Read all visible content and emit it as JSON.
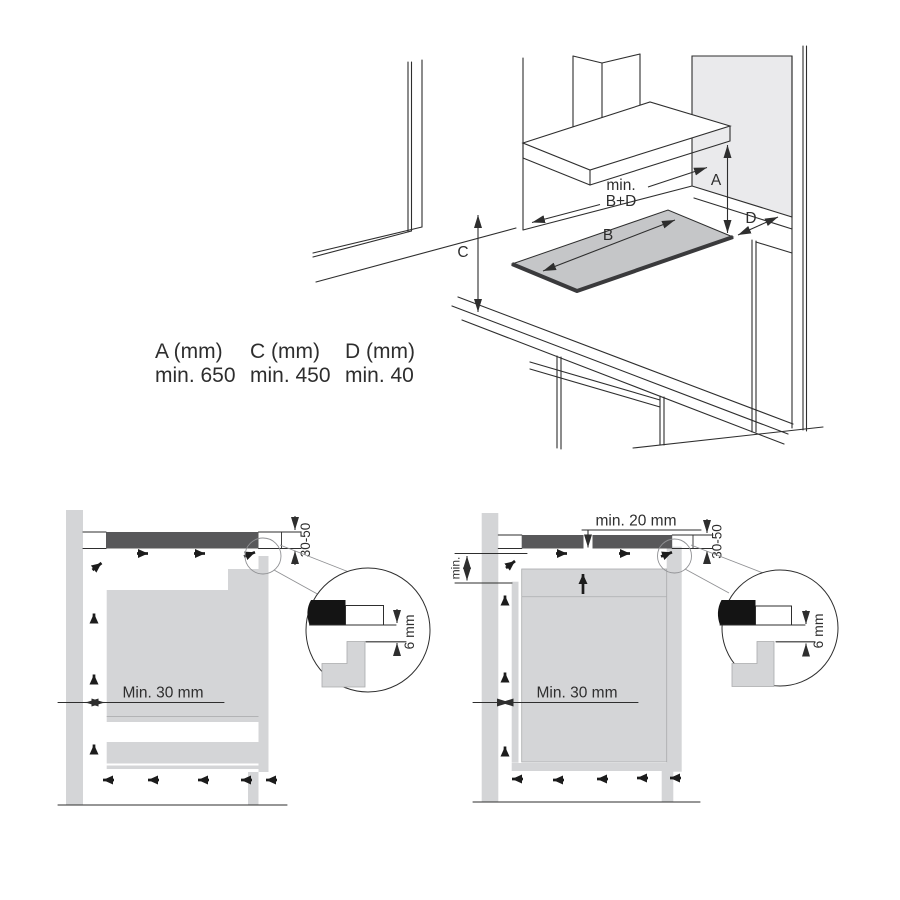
{
  "colors": {
    "line": "#2e2e2e",
    "hob_dark": "#58585a",
    "fill_light": "#d4d5d7",
    "panel_light": "#eaeaec",
    "hob_top": "#c5c6c8",
    "edge_black": "#141414",
    "leader_gray": "#909194",
    "text": "#2e2e2e",
    "bg": "#ffffff"
  },
  "table": {
    "columns": [
      {
        "header": "A (mm)",
        "value": "min. 650"
      },
      {
        "header": "C (mm)",
        "value": "min. 450"
      },
      {
        "header": "D (mm)",
        "value": "min. 40"
      }
    ]
  },
  "top_diagram": {
    "labels": {
      "min": "min.",
      "b_plus_d": "B+D",
      "a": "A",
      "b": "B",
      "c": "C",
      "d": "D"
    }
  },
  "left_section": {
    "labels": {
      "thickness_range": "30-50",
      "edge_gap": "6 mm",
      "side_clearance": "Min. 30 mm"
    }
  },
  "right_section": {
    "labels": {
      "top_clearance": "min. 20 mm",
      "min_abbrev": "min.",
      "thickness_range": "30-50",
      "edge_gap": "6 mm",
      "side_clearance": "Min. 30 mm"
    }
  }
}
